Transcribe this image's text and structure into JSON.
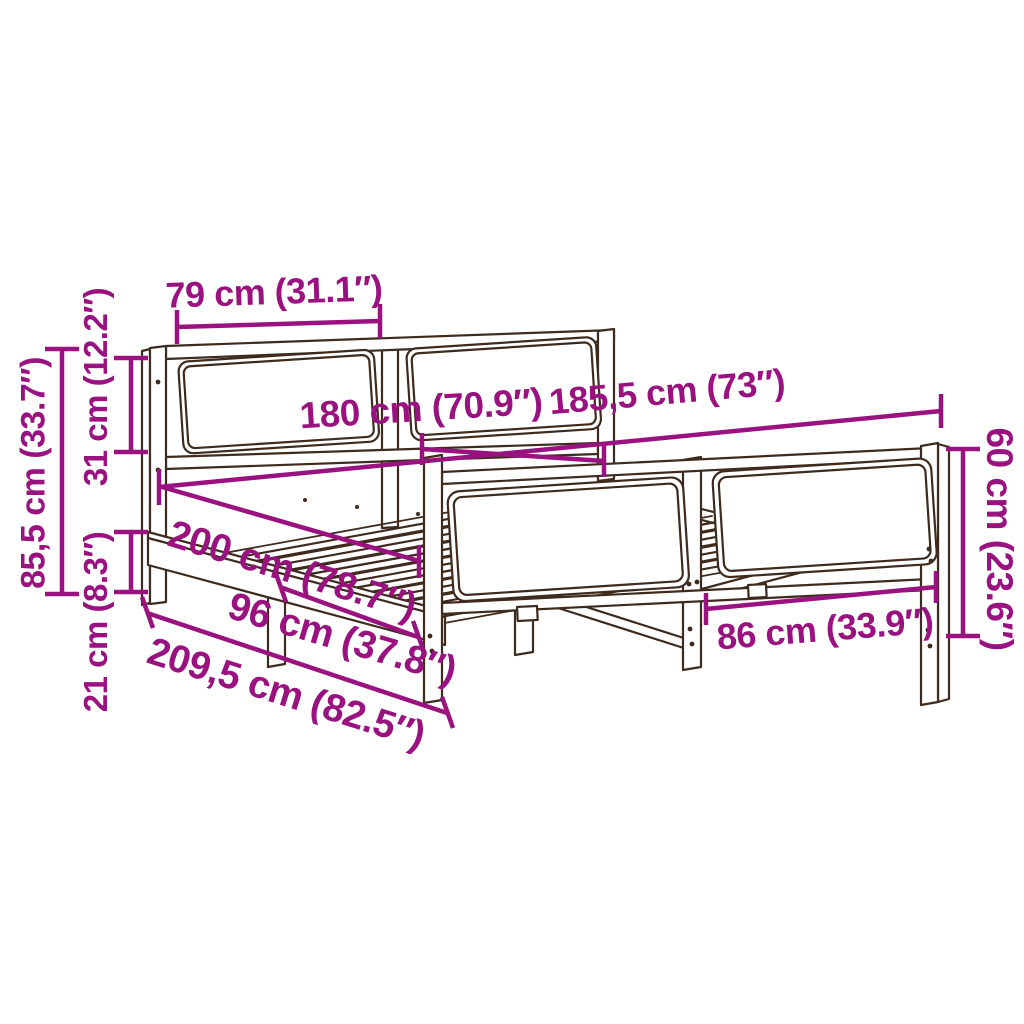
{
  "diagram": {
    "title": "Bed frame dimension diagram",
    "subject": "wooden bed frame with headboard and footboard, slatted base",
    "accent_color": "#9A1280",
    "outline_color": "#3E2B1E",
    "background_color": "#FFFFFF",
    "dimensions": [
      {
        "id": "headboard-panel-width",
        "label": "79 cm (31.1″)"
      },
      {
        "id": "headboard-total-height",
        "label": "85,5 cm (33.7″)"
      },
      {
        "id": "headboard-panel-height",
        "label": "31 cm (12.2″)"
      },
      {
        "id": "base-leg-height",
        "label": "21 cm (8.3″)"
      },
      {
        "id": "mattress-width",
        "label": "180 cm (70.9″)"
      },
      {
        "id": "frame-outer-width",
        "label": "185,5 cm (73″)"
      },
      {
        "id": "mattress-length",
        "label": "200 cm (78.7″)"
      },
      {
        "id": "leg-spacing",
        "label": "96 cm (37.8″)"
      },
      {
        "id": "frame-outer-length",
        "label": "209,5 cm (82.5″)"
      },
      {
        "id": "footboard-panel-width",
        "label": "86 cm (33.9″)"
      },
      {
        "id": "footboard-height",
        "label": "60 cm (23.6″)"
      }
    ]
  }
}
